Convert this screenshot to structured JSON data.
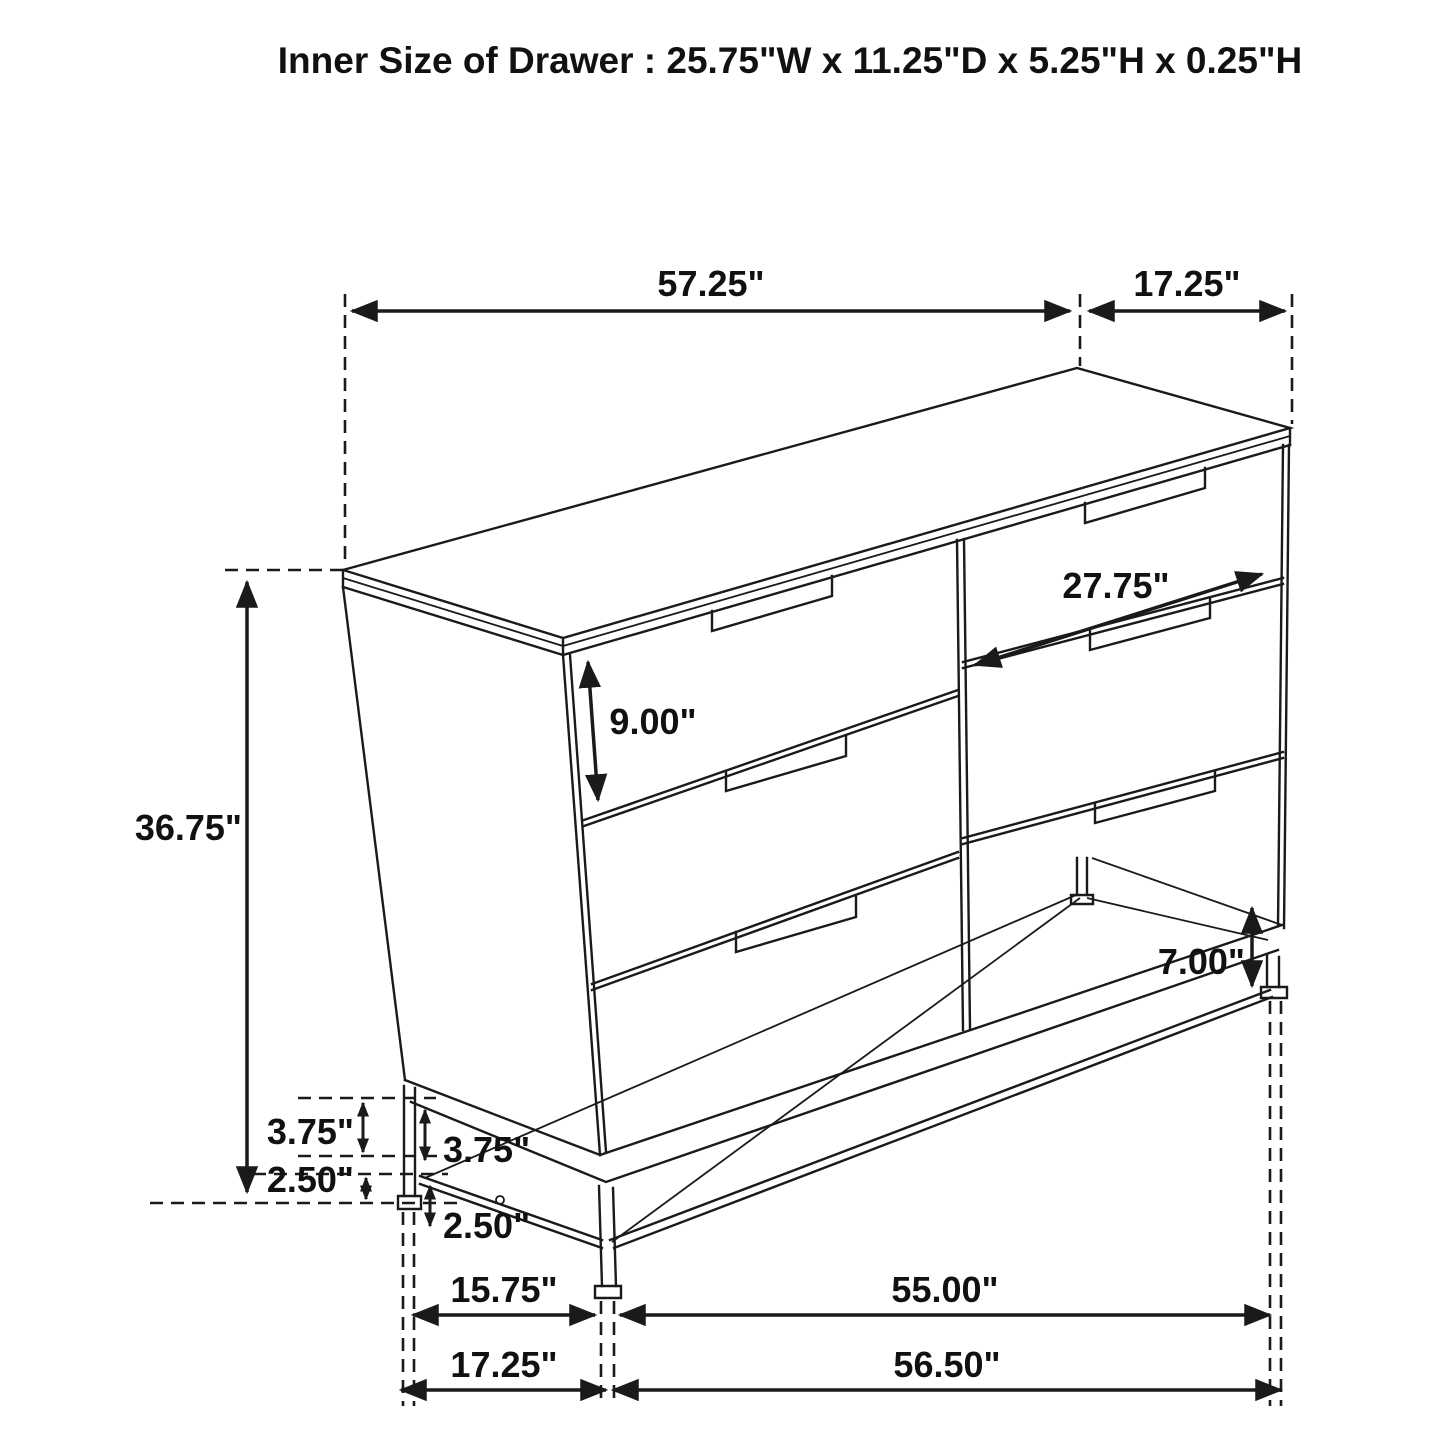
{
  "title": "Inner Size of Drawer : 25.75\"W x 11.25\"D x 5.25\"H x 0.25\"H",
  "dims": {
    "top_width": "57.25\"",
    "top_depth": "17.25\"",
    "drawer_face_width": "27.75\"",
    "drawer_face_height": "9.00\"",
    "overall_height": "36.75\"",
    "leg_clearance": "7.00\"",
    "base_rail_outer": "3.75\"",
    "base_rail_inner": "3.75\"",
    "foot_outer": "2.50\"",
    "foot_inner": "2.50\"",
    "base_side_inner": "15.75\"",
    "base_front_inner": "55.00\"",
    "base_side_outer": "17.25\"",
    "base_front_outer": "56.50\""
  },
  "colors": {
    "line": "#1a1a1a",
    "text": "#111111",
    "background": "#ffffff"
  }
}
